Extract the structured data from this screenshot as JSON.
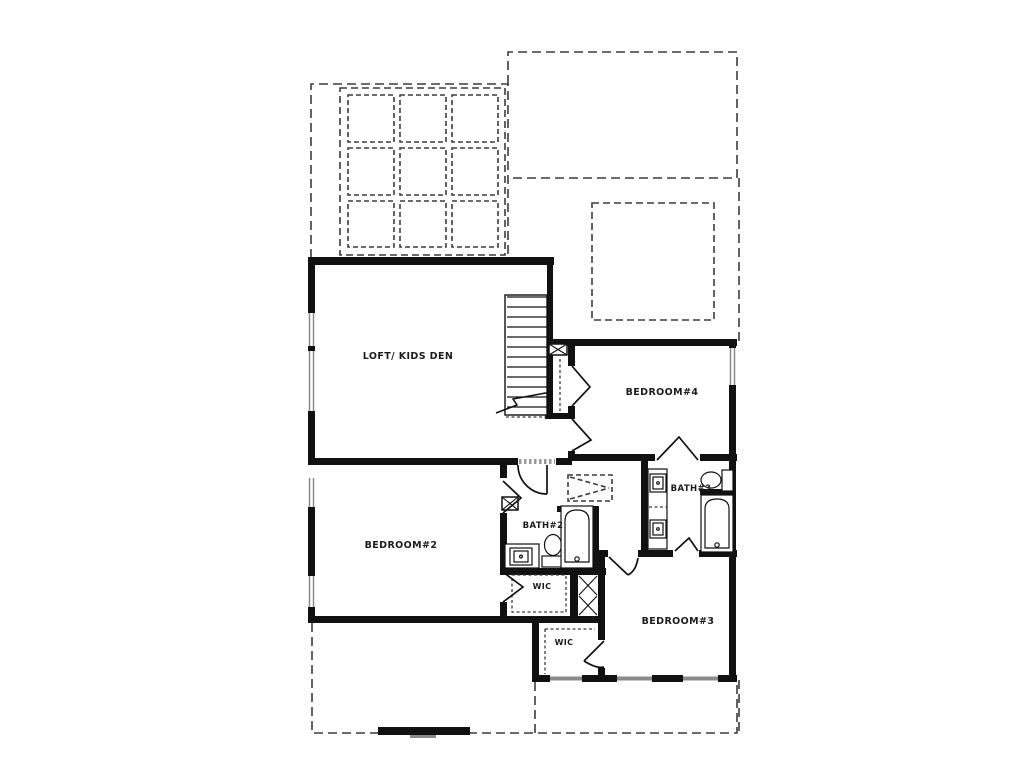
{
  "plan": {
    "rooms": {
      "loft": {
        "label": "LOFT/ KIDS DEN"
      },
      "bedroom4": {
        "label": "BEDROOM#4"
      },
      "bedroom2": {
        "label": "BEDROOM#2"
      },
      "bedroom3": {
        "label": "BEDROOM#3"
      },
      "bath2": {
        "label": "BATH#2"
      },
      "bath3": {
        "label": "BATH#3"
      },
      "wic_upper": {
        "label": "WIC"
      },
      "wic_lower": {
        "label": "WIC"
      }
    },
    "colors": {
      "background": "#ffffff",
      "wall": "#111111",
      "dashed": "#3c3c3c",
      "window": "#8a8a8a",
      "text": "#1c1c1c"
    }
  }
}
